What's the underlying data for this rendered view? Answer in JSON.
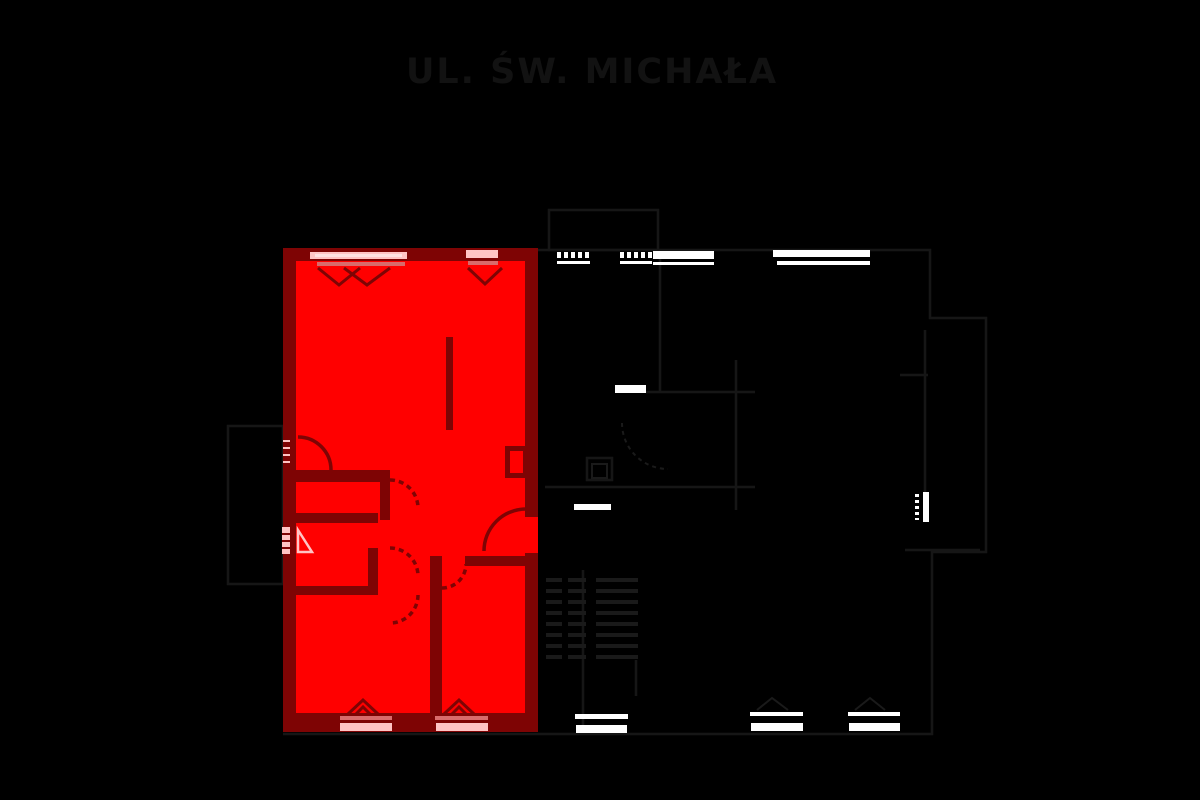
{
  "title": {
    "text": "UL. ŚW. MICHAŁA"
  },
  "colors": {
    "background": "#000000",
    "unit_fill": "#FF0000",
    "unit_wall": "#7E0404",
    "window_pink": "#FFC4C4",
    "window_core": "#FFE2E2",
    "sill_red": "#D96B6B",
    "white": "#FFFFFF",
    "faint_line": "#161616",
    "stair_line": "#1A1A1A",
    "title_color": "#121212"
  },
  "floorplan": {
    "highlighted_unit": {
      "fill": "#FF0000",
      "wall": "#7E0404"
    }
  }
}
